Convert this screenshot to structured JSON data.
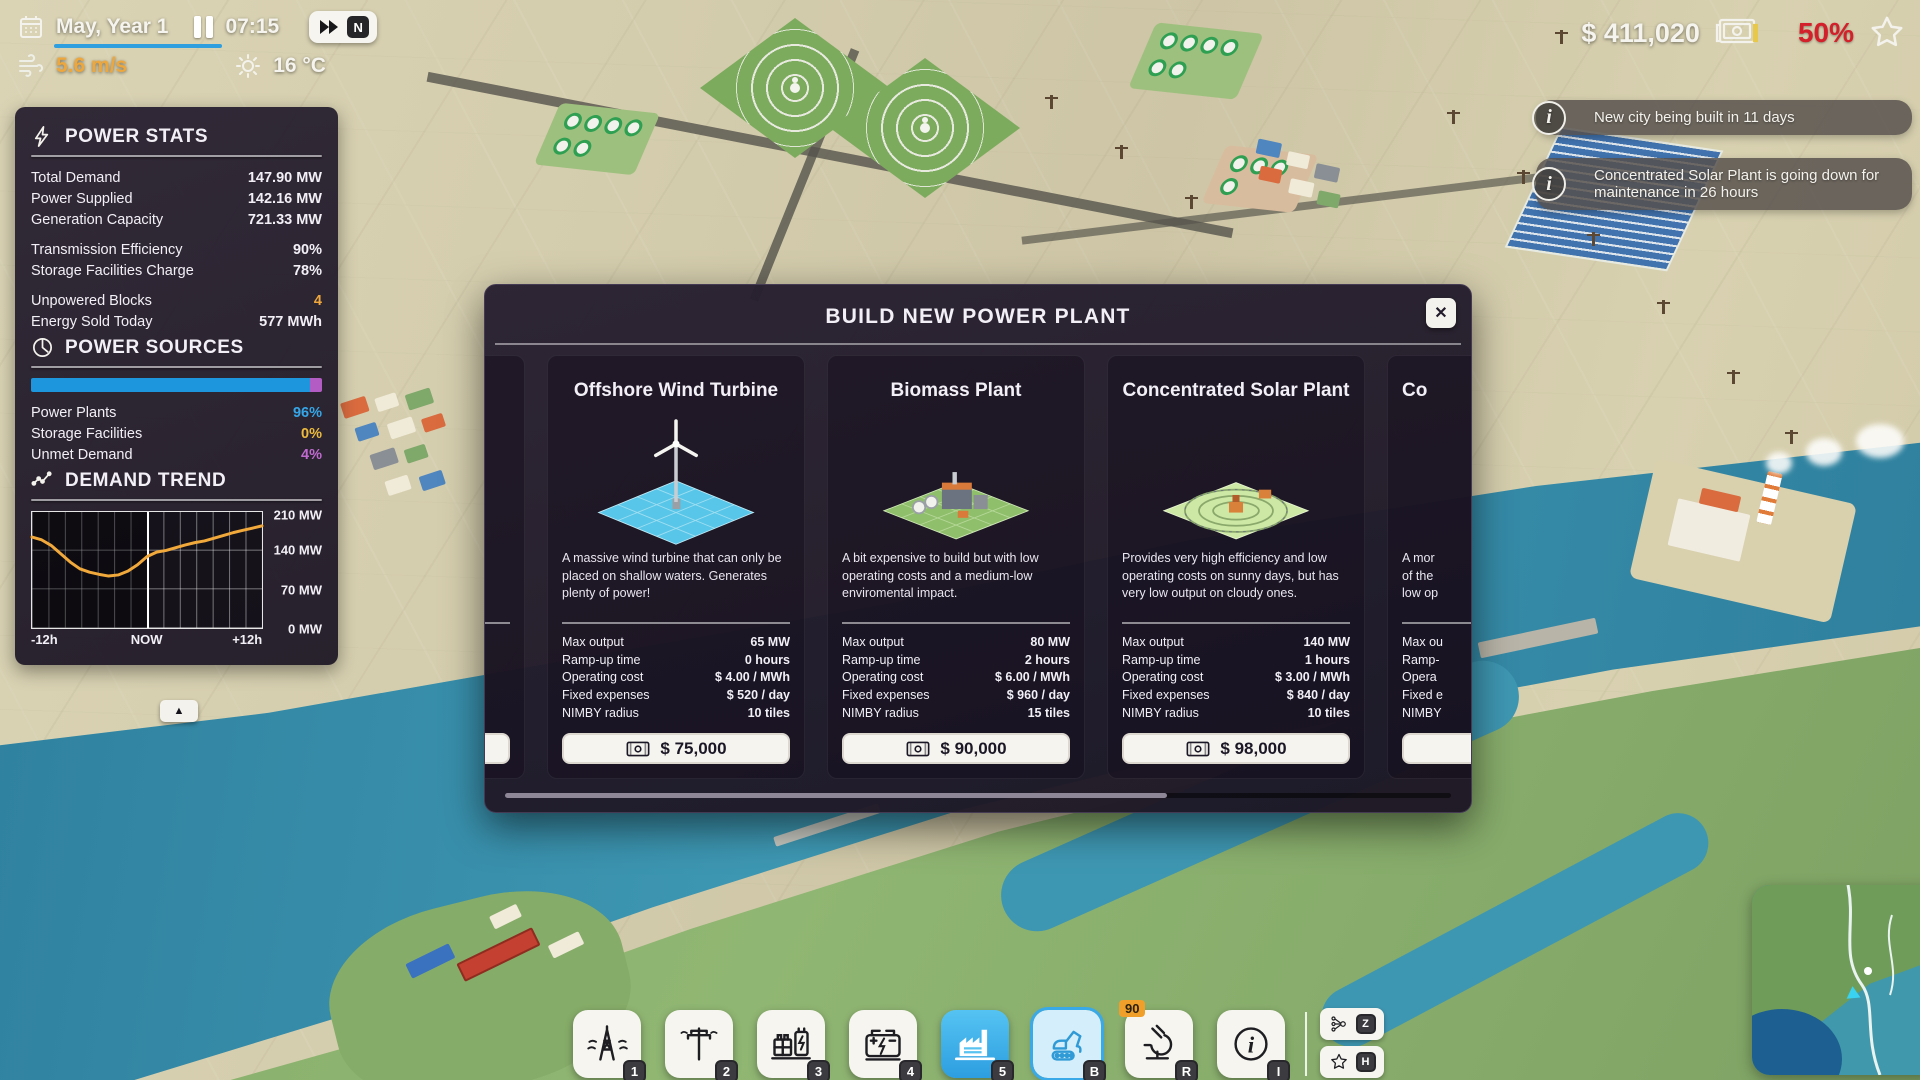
{
  "hud": {
    "date": "May, Year 1",
    "time": "07:15",
    "speed_badge": "N",
    "wind_speed": "5.6 m/s",
    "temperature": "16 °C",
    "money": "$ 411,020",
    "approval": "50%"
  },
  "notifications": [
    {
      "text": "New city being built in 11 days"
    },
    {
      "text": "Concentrated Solar Plant is going down for maintenance in 26 hours"
    }
  ],
  "power_stats": {
    "title": "POWER STATS",
    "rows": [
      {
        "label": "Total Demand",
        "value": "147.90 MW"
      },
      {
        "label": "Power Supplied",
        "value": "142.16 MW"
      },
      {
        "label": "Generation Capacity",
        "value": "721.33 MW"
      },
      {
        "label": "Transmission Efficiency",
        "value": "90%"
      },
      {
        "label": "Storage Facilities Charge",
        "value": "78%"
      },
      {
        "label": "Unpowered Blocks",
        "value": "4"
      },
      {
        "label": "Energy Sold Today",
        "value": "577 MWh"
      }
    ]
  },
  "power_sources": {
    "title": "POWER SOURCES",
    "rows": [
      {
        "label": "Power Plants",
        "value": "96%"
      },
      {
        "label": "Storage Facilities",
        "value": "0%"
      },
      {
        "label": "Unmet Demand",
        "value": "4%"
      }
    ],
    "bar_segments": [
      {
        "name": "power-plants",
        "pct": 96,
        "color": "#1e96dd"
      },
      {
        "name": "unmet-demand",
        "pct": 4,
        "color": "#b35cc4"
      }
    ]
  },
  "demand_trend": {
    "title": "DEMAND TREND",
    "y_labels": [
      "210 MW",
      "140 MW",
      "70 MW",
      "0 MW"
    ],
    "x_labels": [
      "-12h",
      "NOW",
      "+12h"
    ],
    "collapse_arrow": "▲"
  },
  "chart_data": {
    "type": "line",
    "title": "DEMAND TREND",
    "x_hours": [
      -12,
      -11,
      -10,
      -9,
      -8,
      -7,
      -6,
      -5,
      -4,
      -3,
      -2,
      -1,
      0,
      1,
      2,
      3,
      4,
      5,
      6,
      7,
      8,
      9,
      10,
      11,
      12
    ],
    "values": [
      165,
      160,
      150,
      135,
      120,
      108,
      102,
      98,
      95,
      97,
      104,
      115,
      130,
      138,
      141,
      146,
      151,
      155,
      158,
      163,
      168,
      173,
      177,
      181,
      185
    ],
    "ylim": [
      0,
      210
    ],
    "ylabel_ticks": [
      "210 MW",
      "140 MW",
      "70 MW",
      "0 MW"
    ],
    "xlabel_ticks": [
      "-12h",
      "NOW",
      "+12h"
    ],
    "line_color": "#f2a93b",
    "grid": true
  },
  "modal": {
    "title": "BUILD NEW POWER PLANT",
    "close_glyph": "✕",
    "cards": [
      {
        "title": "Offshore Wind Turbine",
        "description": "A massive wind turbine that can only be placed on shallow waters. Generates plenty of power!",
        "stats": [
          {
            "label": "Max output",
            "value": "65 MW"
          },
          {
            "label": "Ramp-up time",
            "value": "0 hours"
          },
          {
            "label": "Operating cost",
            "value": "$ 4.00 / MWh"
          },
          {
            "label": "Fixed expenses",
            "value": "$ 520 / day"
          },
          {
            "label": "NIMBY radius",
            "value": "10 tiles"
          }
        ],
        "price": "$ 75,000"
      },
      {
        "title": "Biomass Plant",
        "description": "A bit expensive to build but with low operating costs and a medium-low enviromental impact.",
        "stats": [
          {
            "label": "Max output",
            "value": "80 MW"
          },
          {
            "label": "Ramp-up time",
            "value": "2 hours"
          },
          {
            "label": "Operating cost",
            "value": "$ 6.00 / MWh"
          },
          {
            "label": "Fixed expenses",
            "value": "$ 960 / day"
          },
          {
            "label": "NIMBY radius",
            "value": "15 tiles"
          }
        ],
        "price": "$ 90,000"
      },
      {
        "title": "Concentrated Solar Plant",
        "description": "Provides very high efficiency and low operating costs on sunny days, but has very low output on cloudy ones.",
        "stats": [
          {
            "label": "Max output",
            "value": "140 MW"
          },
          {
            "label": "Ramp-up time",
            "value": "1 hours"
          },
          {
            "label": "Operating cost",
            "value": "$ 3.00 / MWh"
          },
          {
            "label": "Fixed expenses",
            "value": "$ 840 / day"
          },
          {
            "label": "NIMBY radius",
            "value": "10 tiles"
          }
        ],
        "price": "$ 98,000"
      },
      {
        "title": "Co",
        "description_lines": [
          "A mor",
          "of the",
          "low op"
        ],
        "stat_labels": [
          "Max ou",
          "Ramp-",
          "Opera",
          "Fixed e",
          "NIMBY"
        ]
      }
    ]
  },
  "toolbar": {
    "buttons": [
      {
        "name": "transmission-lines",
        "hotkey": "1"
      },
      {
        "name": "power-pole",
        "hotkey": "2"
      },
      {
        "name": "substation",
        "hotkey": "3"
      },
      {
        "name": "battery-storage",
        "hotkey": "4"
      },
      {
        "name": "power-plants",
        "hotkey": "5"
      },
      {
        "name": "bulldozer",
        "hotkey": "B"
      },
      {
        "name": "research",
        "hotkey": "R",
        "badge": "90"
      },
      {
        "name": "info",
        "hotkey": "I"
      }
    ],
    "side_buttons": [
      {
        "name": "overlays",
        "hotkey": "Z"
      },
      {
        "name": "favorites",
        "hotkey": "H"
      }
    ]
  }
}
